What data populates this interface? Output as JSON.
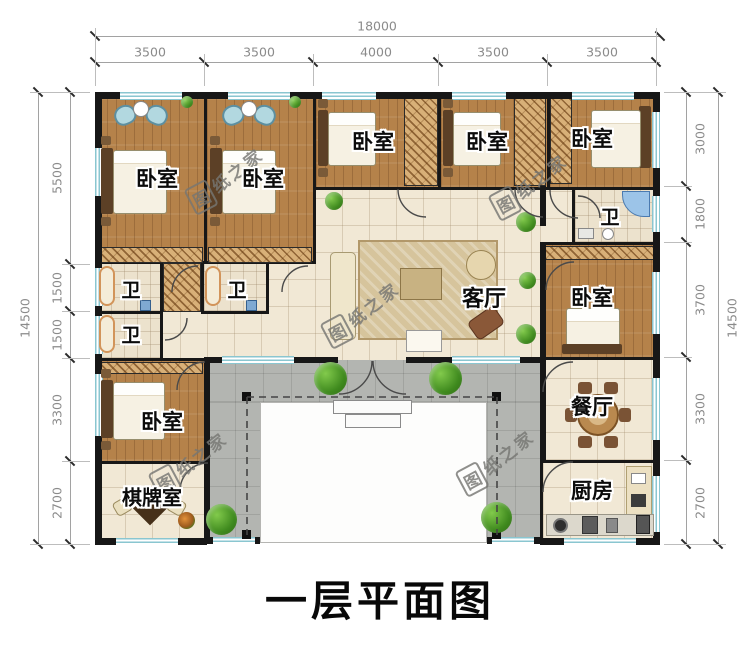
{
  "title": "一层平面图",
  "watermark": {
    "first_char": "图",
    "rest": "纸之家"
  },
  "dims": {
    "top_total": "18000",
    "top_segments": [
      "3500",
      "3500",
      "4000",
      "3500",
      "3500"
    ],
    "left_total": "14500",
    "left_segments": [
      "5500",
      "1500",
      "1500",
      "3300",
      "2700"
    ],
    "right_total": "14500",
    "right_segments": [
      "3000",
      "1800",
      "3700",
      "3300",
      "2700"
    ]
  },
  "rooms": {
    "bedroom_a": "卧室",
    "bedroom_b": "卧室",
    "bedroom_c": "卧室",
    "bedroom_d": "卧室",
    "bedroom_e": "卧室",
    "bedroom_f": "卧室",
    "bedroom_g": "卧室",
    "bath_a": "卫",
    "bath_b": "卫",
    "bath_c": "卫",
    "bath_e": "卫",
    "living": "客厅",
    "dining": "餐厅",
    "kitchen": "厨房",
    "chess": "棋牌室"
  },
  "colors": {
    "wall": "#171717",
    "wood_floor": "#b5824a",
    "tile_floor": "#f1e8d5",
    "veranda": "#b3b5b1",
    "window": "#8ac6d0",
    "dim_text": "#8b8b8b",
    "watermark": "#767673"
  }
}
